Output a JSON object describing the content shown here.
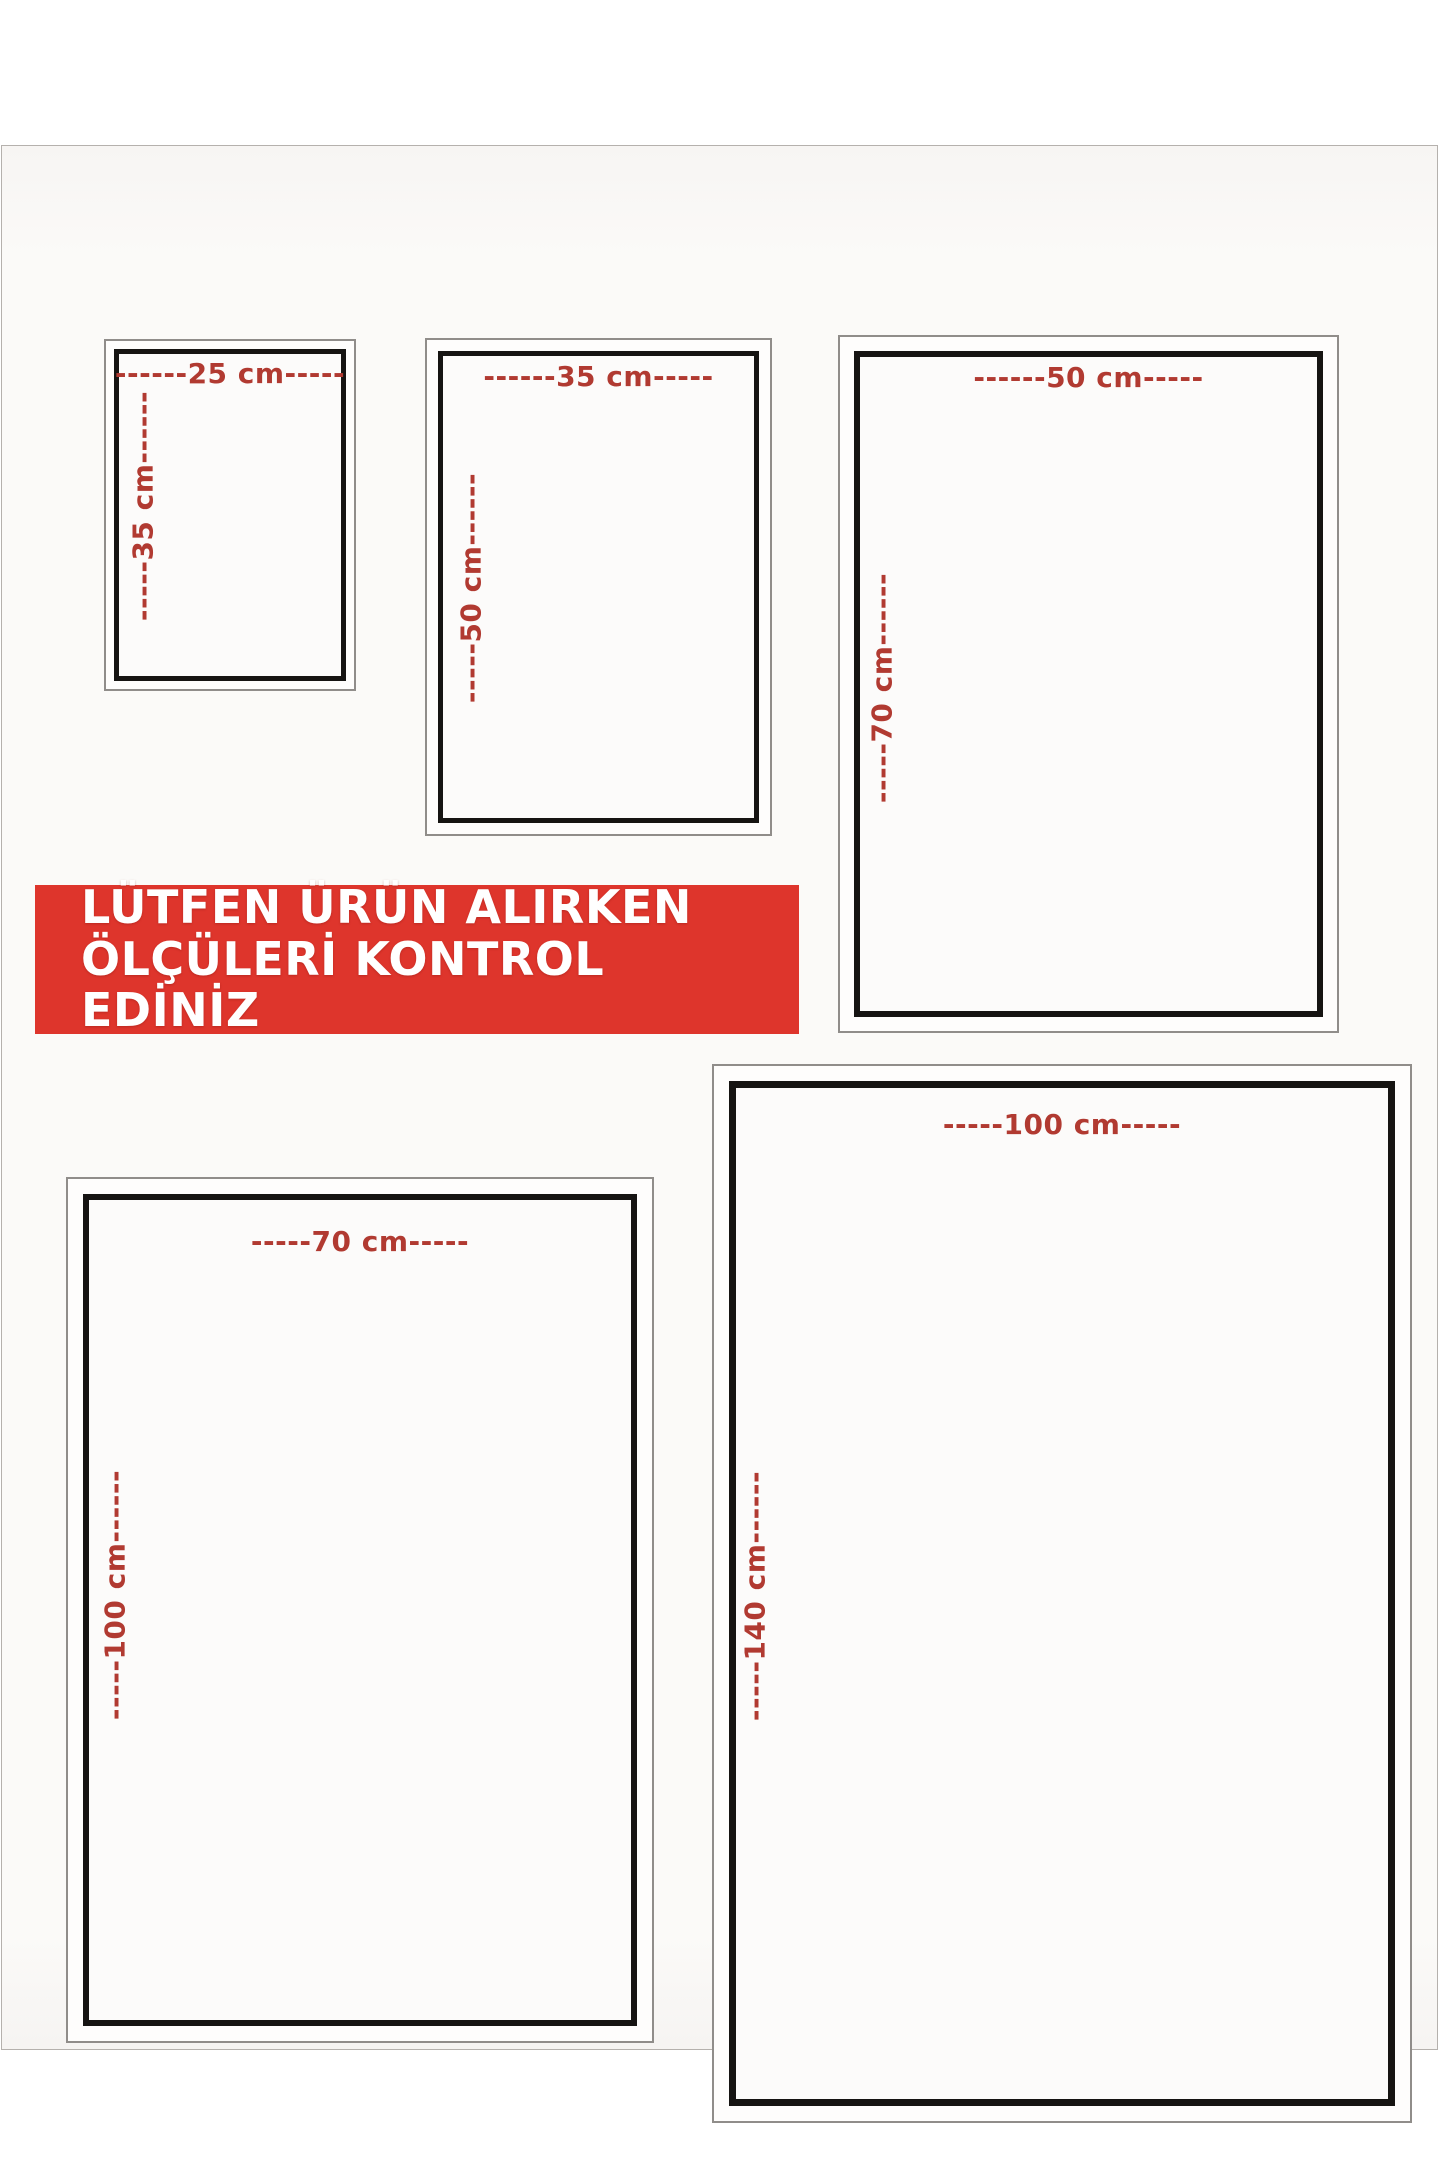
{
  "banner": {
    "line1": "LÜTFEN ÜRÜN ALIRKEN",
    "line2": "ÖLÇÜLERİ KONTROL EDİNİZ",
    "background_color": "#de352c",
    "text_color": "#ffffff"
  },
  "colors": {
    "dimension_label": "#b13a31",
    "box_border_black": "#161412",
    "box_border_grey": "#908d8a",
    "photo_background": "#fbfaf8"
  },
  "boxes": [
    {
      "id": "25x35",
      "width_cm": 25,
      "height_cm": 35,
      "width_label": "------25 cm-----",
      "height_label": "-----35 cm------"
    },
    {
      "id": "35x50",
      "width_cm": 35,
      "height_cm": 50,
      "width_label": "------35 cm-----",
      "height_label": "-----50 cm------"
    },
    {
      "id": "50x70",
      "width_cm": 50,
      "height_cm": 70,
      "width_label": "------50 cm-----",
      "height_label": "-----70 cm------"
    },
    {
      "id": "70x100",
      "width_cm": 70,
      "height_cm": 100,
      "width_label": "-----70 cm-----",
      "height_label": "-----100 cm------"
    },
    {
      "id": "100x140",
      "width_cm": 100,
      "height_cm": 140,
      "width_label": "-----100 cm-----",
      "height_label": "-----140 cm------"
    }
  ]
}
